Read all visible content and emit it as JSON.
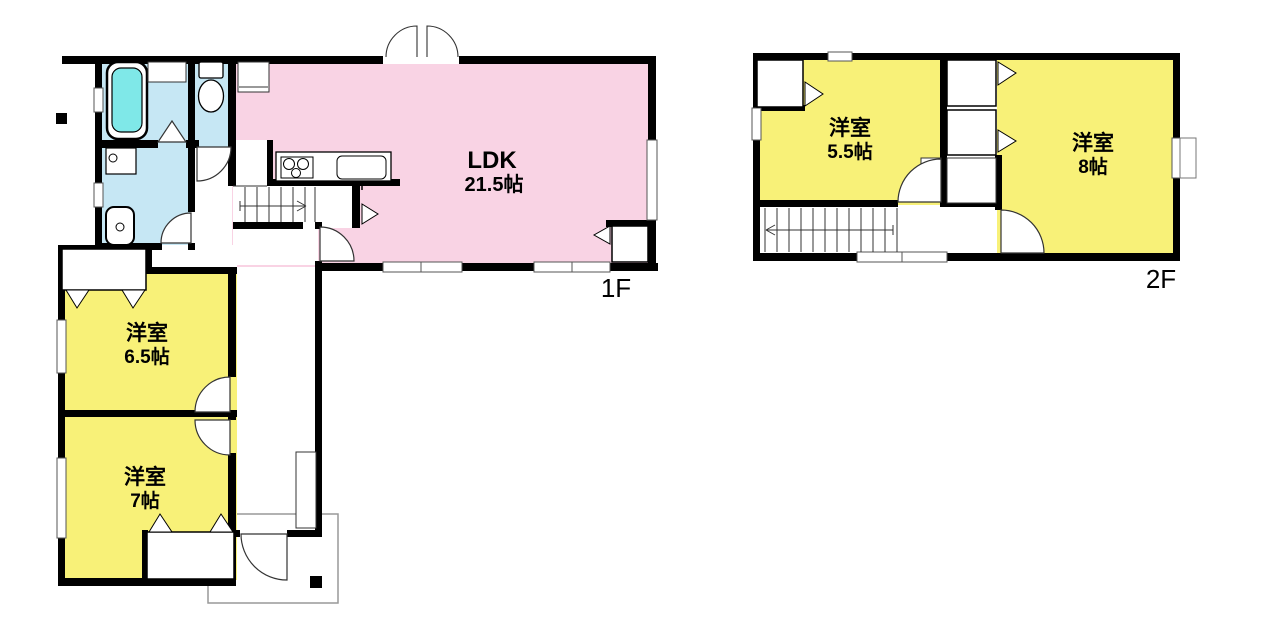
{
  "floor1": {
    "label": "1F",
    "ldk": {
      "name": "LDK",
      "size": "21.5帖"
    },
    "room65": {
      "name": "洋室",
      "size": "6.5帖"
    },
    "room7": {
      "name": "洋室",
      "size": "7帖"
    }
  },
  "floor2": {
    "label": "2F",
    "room55": {
      "name": "洋室",
      "size": "5.5帖"
    },
    "room8": {
      "name": "洋室",
      "size": "8帖"
    }
  },
  "colors": {
    "ldk_pink": "#F9D3E4",
    "room_yellow": "#F8F178",
    "wet_blue": "#C6E7F4",
    "tub_cyan": "#7FE8E8",
    "wall_black": "#000000",
    "white": "#FFFFFF"
  }
}
